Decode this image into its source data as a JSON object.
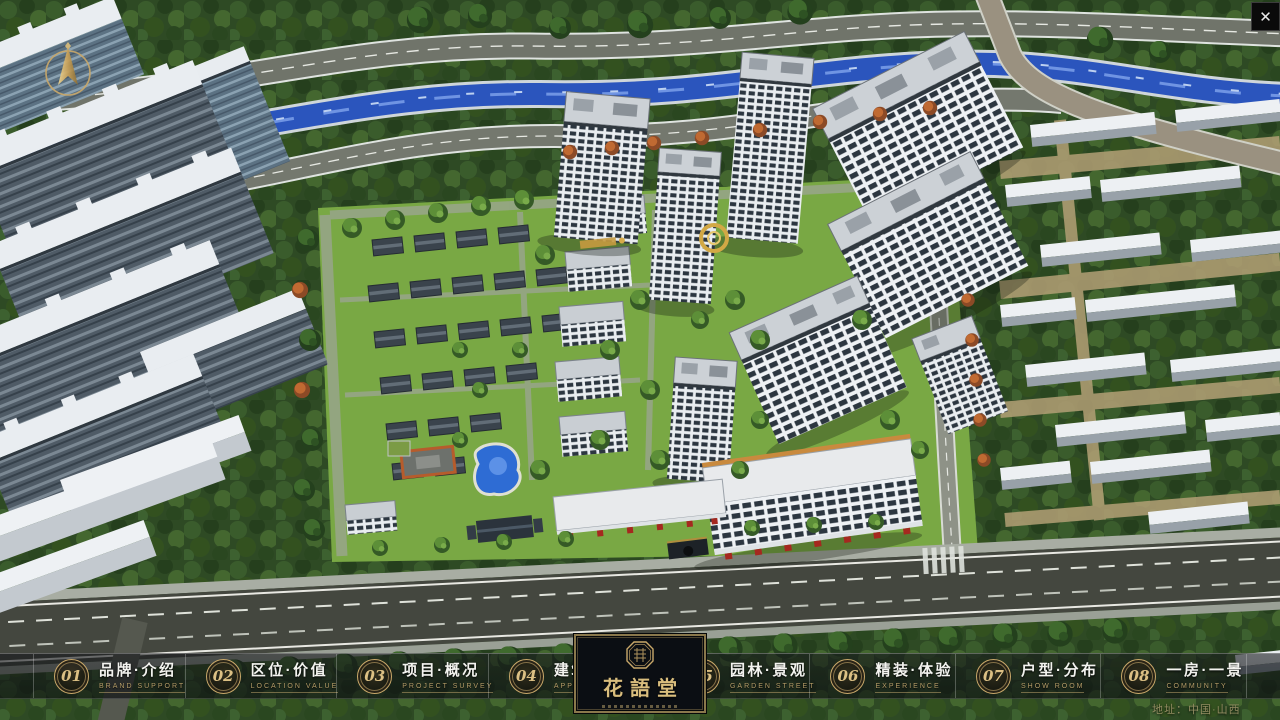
{
  "window": {
    "close_glyph": "✕"
  },
  "logo": {
    "title": "花語堂"
  },
  "menu": {
    "items": [
      {
        "num": "01",
        "zh": "品牌·介绍",
        "en": "BRAND SUPPORT"
      },
      {
        "num": "02",
        "zh": "区位·价值",
        "en": "LOCATION VALUE"
      },
      {
        "num": "03",
        "zh": "项目·概况",
        "en": "PROJECT SURVEY"
      },
      {
        "num": "04",
        "zh": "建筑·鉴赏",
        "en": "APPRECIATION"
      },
      {
        "num": "05",
        "zh": "园林·景观",
        "en": "GARDEN STREET"
      },
      {
        "num": "06",
        "zh": "精装·体验",
        "en": "EXPERIENCE"
      },
      {
        "num": "07",
        "zh": "户型·分布",
        "en": "SHOW ROOM"
      },
      {
        "num": "08",
        "zh": "一房·一景",
        "en": "COMMUNITY"
      }
    ]
  },
  "footer": {
    "address": "地址：中国·山西"
  },
  "colors": {
    "gold": "#c9a86a",
    "river": "#2b55bd",
    "lawn": "#79a844"
  }
}
